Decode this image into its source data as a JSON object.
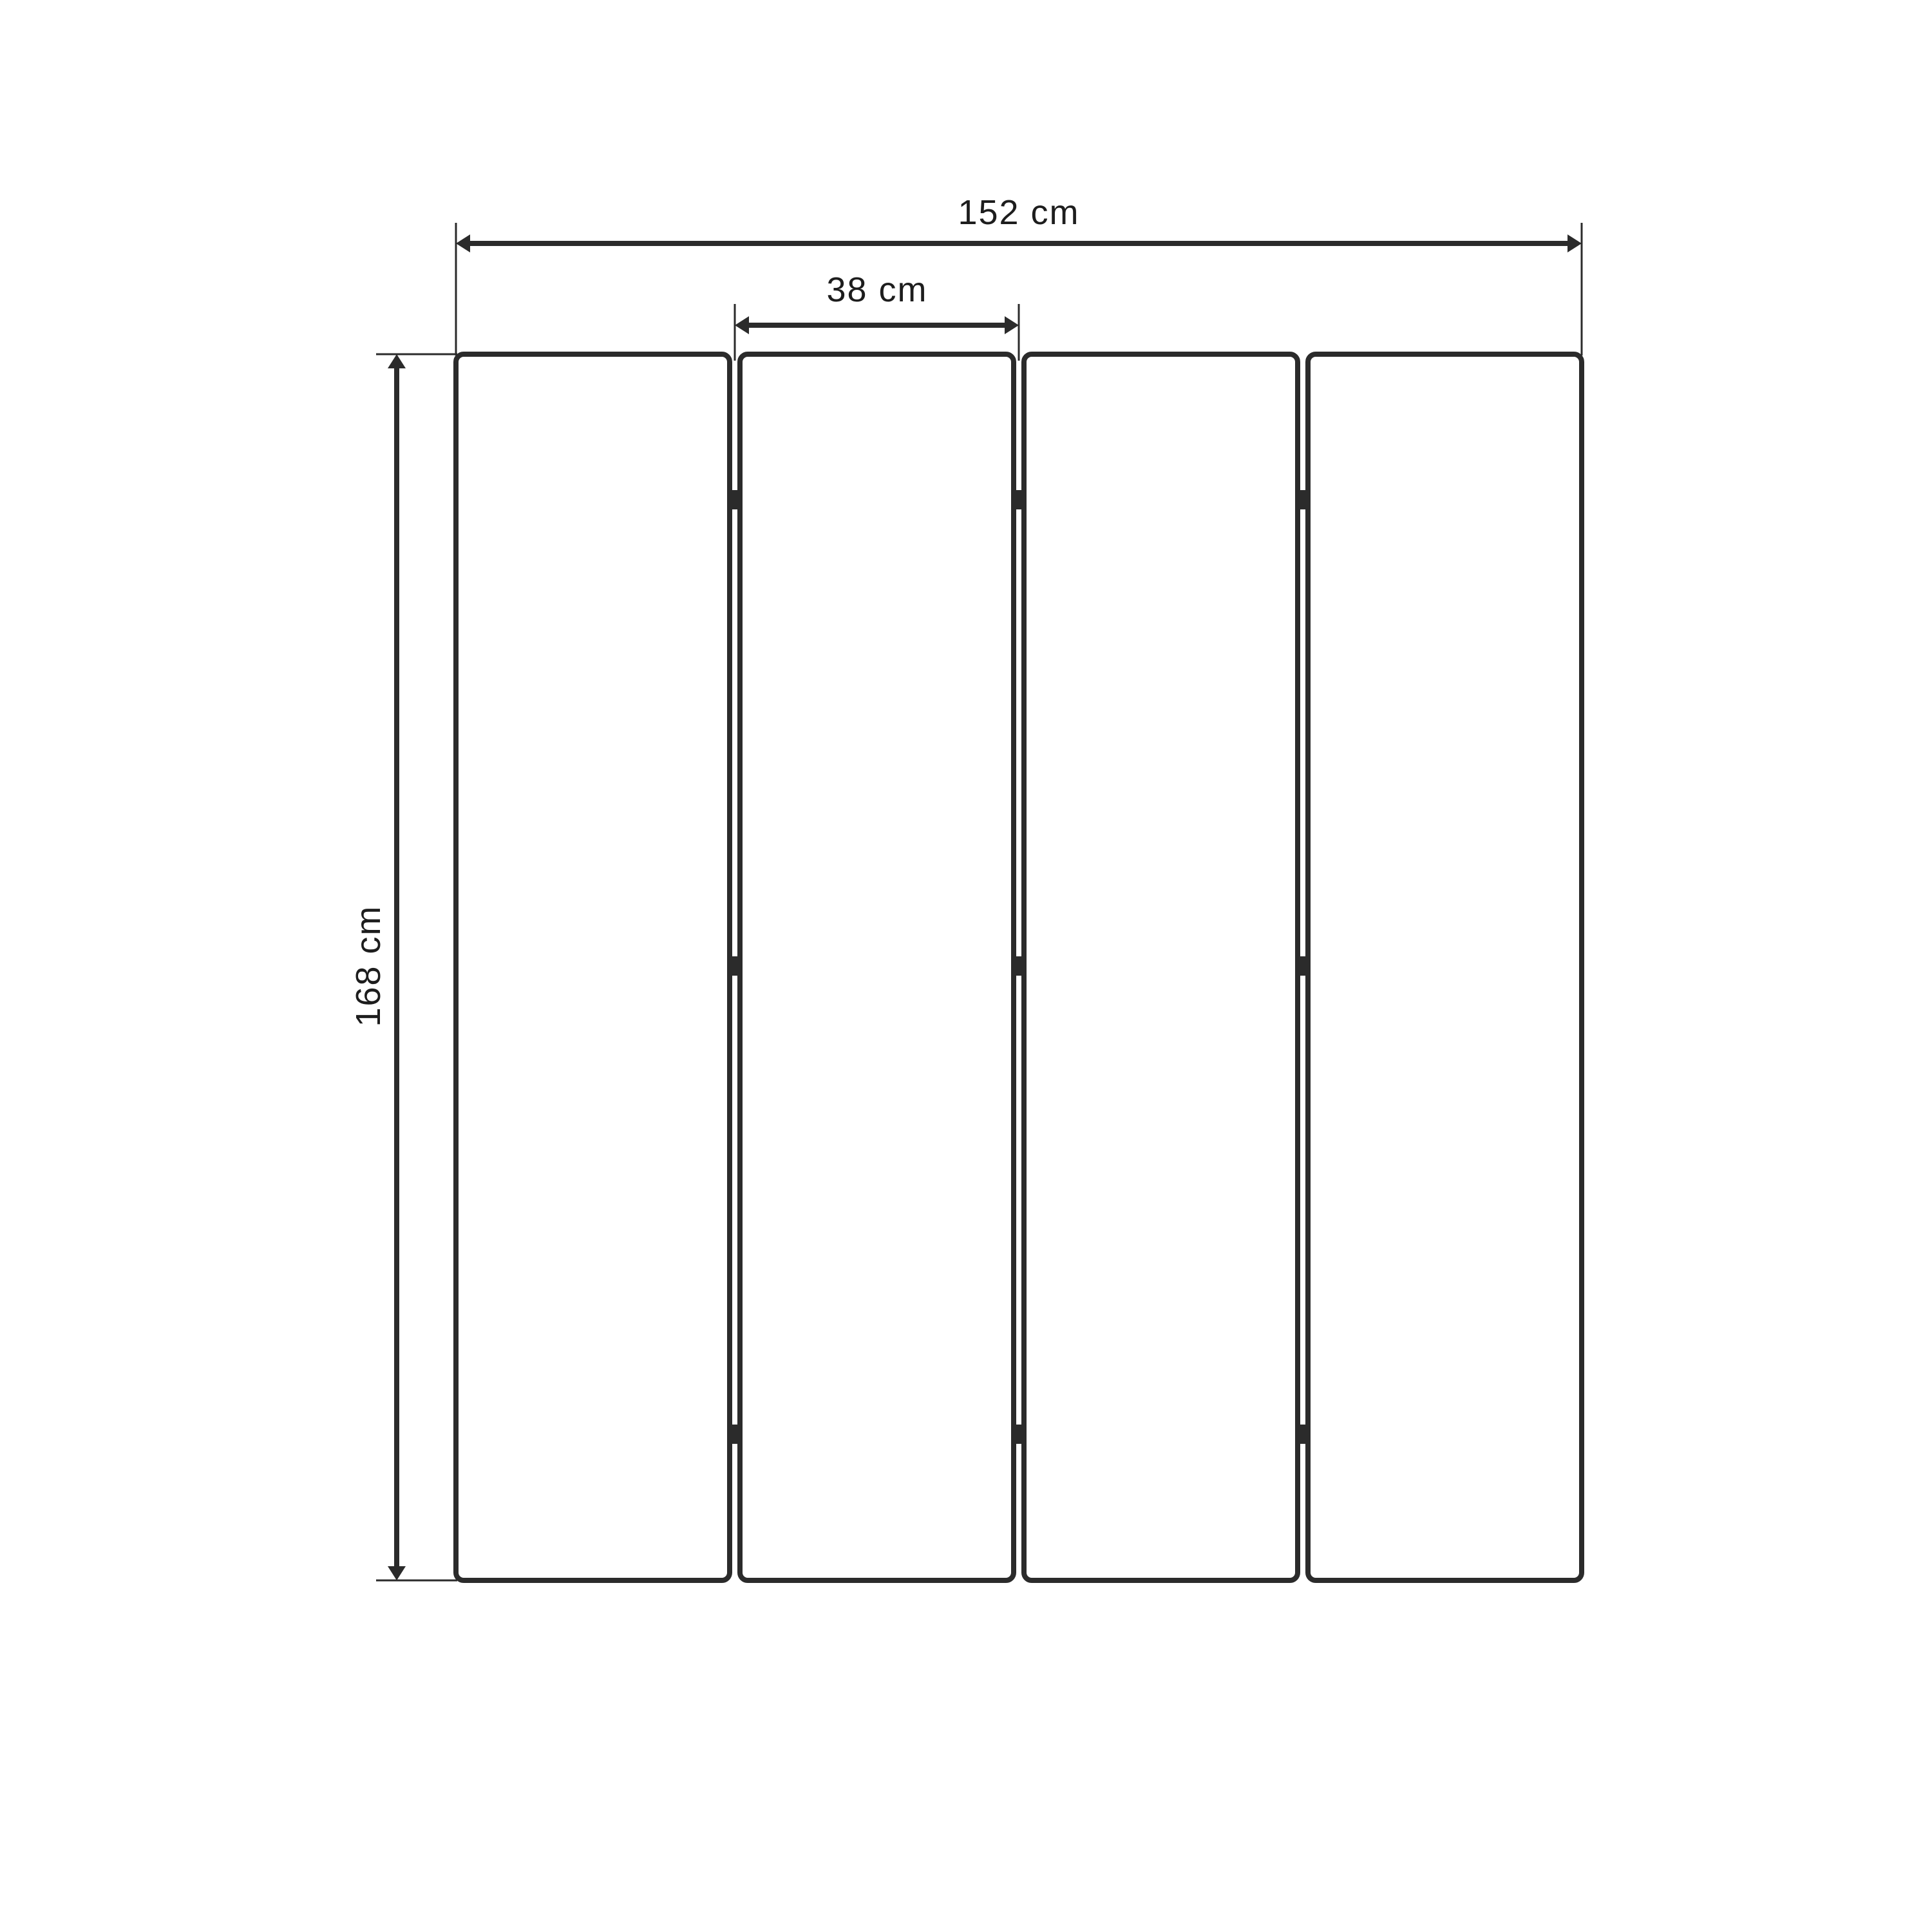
{
  "diagram": {
    "title": "folding-screen-dimension-drawing",
    "colors": {
      "line": "#2b2b2b",
      "text": "#1d1d1d",
      "background": "#ffffff"
    },
    "panels": {
      "count": 4,
      "gaps": 3,
      "hinges_per_gap": 3
    },
    "dimensions": {
      "total_width": {
        "label": "152 cm",
        "value": 152,
        "unit": "cm"
      },
      "panel_width": {
        "label": "38 cm",
        "value": 38,
        "unit": "cm"
      },
      "height": {
        "label": "168 cm",
        "value": 168,
        "unit": "cm"
      }
    }
  }
}
